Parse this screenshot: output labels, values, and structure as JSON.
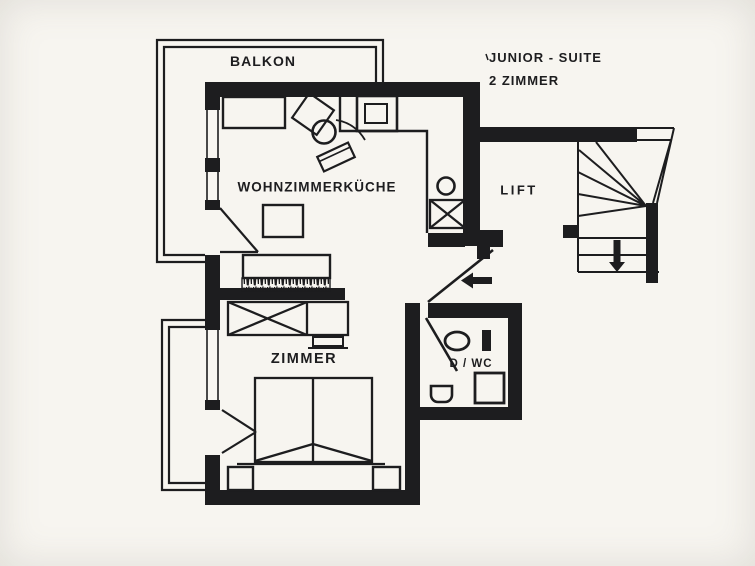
{
  "header": {
    "title": "JUNIOR - SUITE",
    "subtitle": "2 ZIMMER"
  },
  "rooms": {
    "balcony": {
      "label": "BALKON"
    },
    "living_kitchen": {
      "label": "WOHNZIMMERKÜCHE"
    },
    "lift": {
      "label": "LIFT"
    },
    "bedroom": {
      "label": "ZIMMER"
    },
    "shower_wc": {
      "label": "D / WC"
    }
  },
  "icons": {
    "entry_arrow": "left-arrow",
    "stairs_direction": "down-arrow"
  },
  "colors": {
    "ink": "#1d1d1f",
    "paper": "#f7f5f0"
  }
}
